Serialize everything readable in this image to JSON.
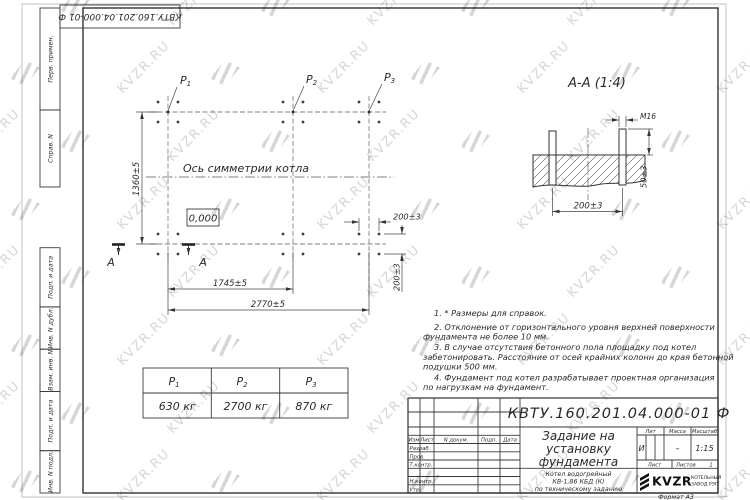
{
  "watermark": {
    "text": "KVZR.RU",
    "color": "#bcbcbc"
  },
  "top_stamp": {
    "doc_number": "КВТУ.160.201.04.000-01 Ф"
  },
  "sidebar": {
    "labels": [
      "Перв. примен.",
      "Справ. N",
      "Подп. и дата",
      "Инв. N дубл.",
      "Взам. инв. N",
      "Подп. и дата",
      "Инв. N подл."
    ]
  },
  "plan": {
    "points": [
      {
        "symbol": "P",
        "index": "1"
      },
      {
        "symbol": "P",
        "index": "2"
      },
      {
        "symbol": "P",
        "index": "3"
      }
    ],
    "axis_label": "Ось симметрии котла",
    "elevation": "0,000",
    "section_letter": "А",
    "dim_height": "1360±5",
    "dim_span_mid": "1745±5",
    "dim_span_full": "2770±5",
    "dim_bolt_x": "200±3",
    "dim_bolt_y": "200±3"
  },
  "section": {
    "title": "А-А (1:4)",
    "thread_label": "М16",
    "dim_protrusion": "50±3",
    "dim_spacing": "200±3"
  },
  "loads_table": {
    "columns": [
      {
        "symbol": "P",
        "index": "1",
        "value": "630 кг"
      },
      {
        "symbol": "P",
        "index": "2",
        "value": "2700 кг"
      },
      {
        "symbol": "P",
        "index": "3",
        "value": "870 кг"
      }
    ]
  },
  "notes": {
    "lines": [
      "1. * Размеры для справок.",
      "2. Отклонение от горизонтального уровня верхней поверхности",
      "фундамента не более 10 мм.",
      "3. В случае отсутствия бетонного пола площадку под котел",
      "забетонировать. Расстояние от осей крайних колонн до края бетонной",
      "подушки 500 мм.",
      "4. Фундамент под котел разрабатывает проектная организация",
      "по нагрузкам на фундамент."
    ]
  },
  "title_block": {
    "doc_number": "КВТУ.160.201.04.000-01 Ф",
    "title_lines": [
      "Задание на",
      "установку",
      "фундамента"
    ],
    "subtitle_lines": [
      "Котел водогрейный",
      "КВ-1,86 КБД (К)",
      "по техническому заданию"
    ],
    "header_izm": "Изм",
    "header_list": "Лист",
    "header_ndoc": "N докум.",
    "header_podp": "Подп.",
    "header_data": "Дата",
    "rows": [
      "Разраб.",
      "Пров.",
      "Т.контр.",
      "Н.контр.",
      "Утв."
    ],
    "lit_header": "Лит",
    "mass_header": "Масса",
    "scale_header": "Масштаб",
    "lit_value": "И",
    "mass_value": "–",
    "scale_value": "1:15",
    "sheet_label": "Лист",
    "sheets_label": "Листов",
    "sheets_value": "1",
    "logo_text": "KVZR",
    "logo_sub1": "КОТЕЛЬНЫЙ",
    "logo_sub2": "ЗАВОД РЭП",
    "format_label": "Формат А3"
  }
}
